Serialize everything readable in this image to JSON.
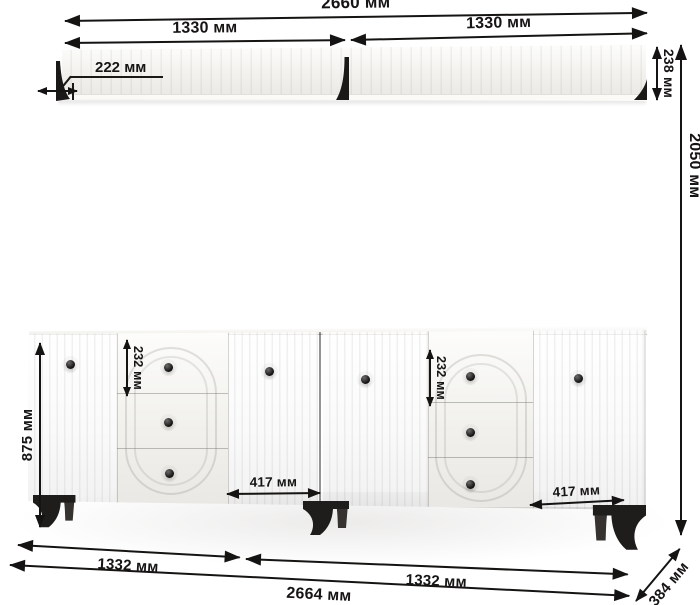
{
  "title": "furniture-dimension-diagram",
  "units": "мм",
  "palette": {
    "line": "#151413",
    "body": "#f6f5f1",
    "dark_parts": "#1f1d1b"
  },
  "furniture": {
    "shelf_sections": 2,
    "cabinet_doors": 4,
    "cabinet_drawers": 6
  },
  "dims": {
    "shelf_total_width": "2660 мм",
    "shelf_left_width": "1330 мм",
    "shelf_right_width": "1330 мм",
    "shelf_depth": "222 мм",
    "shelf_height": "238 мм",
    "overall_height": "2050 мм",
    "cabinet_height": "875 мм",
    "drawer_height_left": "232 мм",
    "drawer_height_right": "232 мм",
    "door_width_left": "417 мм",
    "door_width_right": "417 мм",
    "cabinet_left_width": "1332 мм",
    "cabinet_right_width": "1332 мм",
    "cabinet_total_width": "2664 мм",
    "cabinet_depth": "384 мм"
  }
}
